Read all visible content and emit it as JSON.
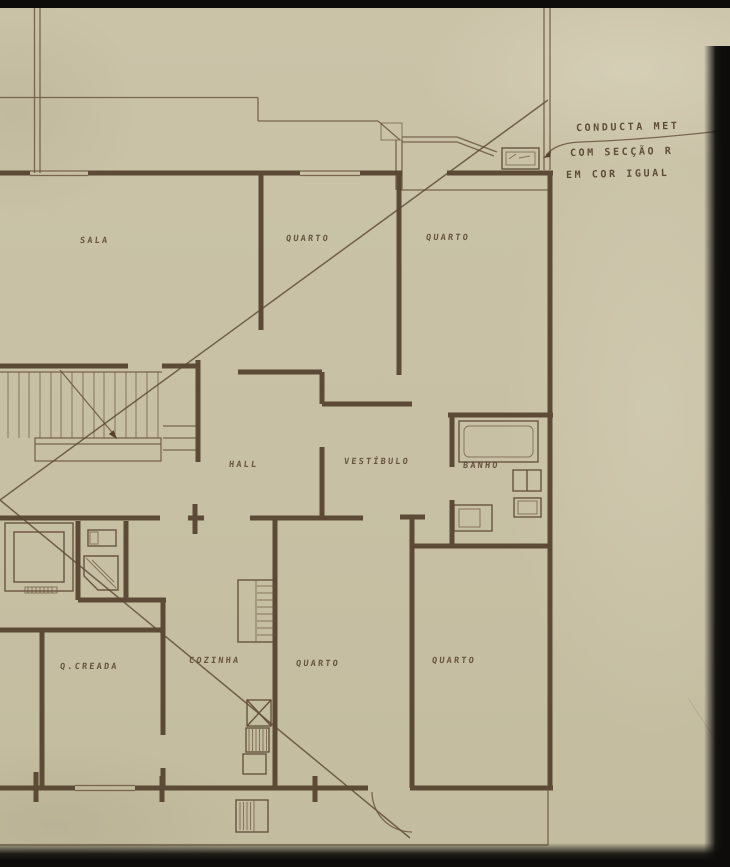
{
  "drawing": {
    "annotation": {
      "line1": "CONDUCTA MET",
      "line2": "COM SECÇÃO R",
      "line3": "EM COR IGUAL"
    },
    "room_labels": {
      "sala": "SALA",
      "quarto_top_1": "QUARTO",
      "quarto_top_2": "QUARTO",
      "hall": "HALL",
      "vestibulo": "VESTÍBULO",
      "banho": "BANHO",
      "quarto_criada": "Q.CREADA",
      "cozinha": "COZINHA",
      "quarto_bottom_1": "QUARTO",
      "quarto_bottom_2": "QUARTO",
      "edge_fragment": "A"
    }
  },
  "colors": {
    "paper": "#c8c1a6",
    "paper_light": "#d9d3bf",
    "ink": "#53402c",
    "ink_light": "#6a563f",
    "scan_border": "#0d0c0a"
  }
}
